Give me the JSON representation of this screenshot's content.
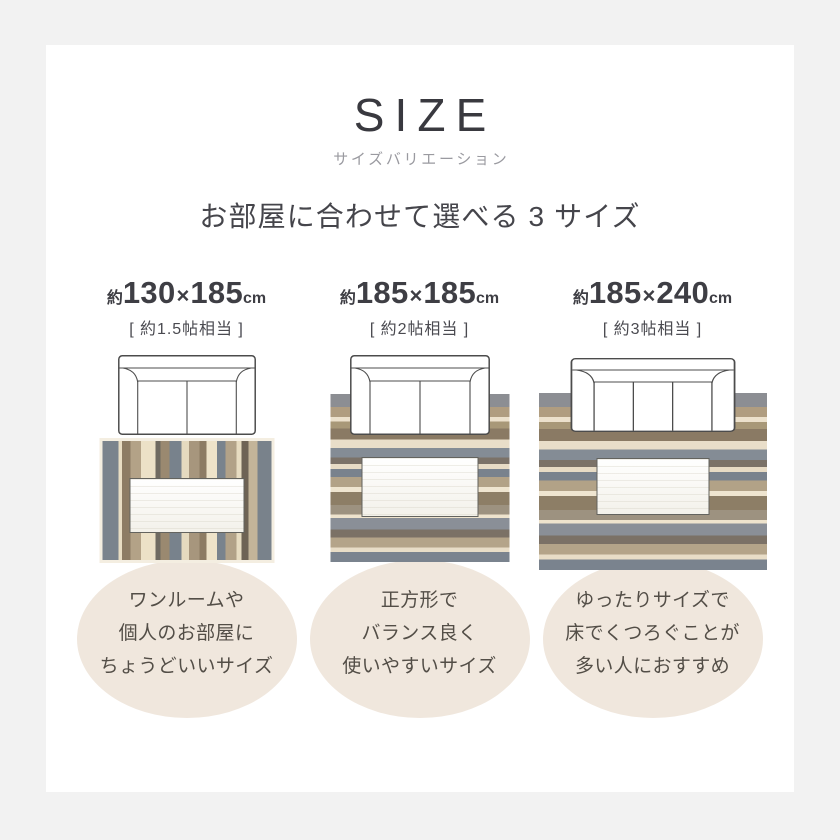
{
  "header": {
    "title": "SIZE",
    "subtitle": "サイズバリエーション",
    "heading": "お部屋に合わせて選べる 3 サイズ"
  },
  "sizes": [
    {
      "approx": "約",
      "width": "130",
      "separator": "×",
      "depth": "185",
      "unit": "cm",
      "equivalent": "[ 約1.5帖相当 ]",
      "description_lines": [
        "ワンルームや",
        "個人のお部屋に",
        "ちょうどいいサイズ"
      ],
      "sofa_seats": 2,
      "rug_orientation": "vertical"
    },
    {
      "approx": "約",
      "width": "185",
      "separator": "×",
      "depth": "185",
      "unit": "cm",
      "equivalent": "[ 約2帖相当 ]",
      "description_lines": [
        "正方形で",
        "バランス良く",
        "使いやすいサイズ"
      ],
      "sofa_seats": 2,
      "rug_orientation": "horizontal"
    },
    {
      "approx": "約",
      "width": "185",
      "separator": "×",
      "depth": "240",
      "unit": "cm",
      "equivalent": "[ 約3帖相当 ]",
      "description_lines": [
        "ゆったりサイズで",
        "床でくつろぐことが",
        "多い人におすすめ"
      ],
      "sofa_seats": 3,
      "rug_orientation": "horizontal"
    }
  ],
  "colors": {
    "page_bg": "#f2f2f2",
    "card_bg": "#ffffff",
    "circle_bg": "#f0e7dd",
    "sofa_outline": "#4c4c4c",
    "sofa_fill": "#ffffff"
  },
  "rug_palettes": {
    "vertical": [
      {
        "c": "#7a838d",
        "w": 9
      },
      {
        "c": "#e8ddc3",
        "w": 2
      },
      {
        "c": "#8d7c64",
        "w": 5
      },
      {
        "c": "#b3a287",
        "w": 6
      },
      {
        "c": "#ece1c7",
        "w": 8
      },
      {
        "c": "#6f6a61",
        "w": 3
      },
      {
        "c": "#9a8970",
        "w": 5
      },
      {
        "c": "#78828c",
        "w": 7
      },
      {
        "c": "#e5dabf",
        "w": 4
      },
      {
        "c": "#a7967d",
        "w": 6
      },
      {
        "c": "#8d7c64",
        "w": 4
      },
      {
        "c": "#eee3c9",
        "w": 6
      },
      {
        "c": "#79838d",
        "w": 5
      },
      {
        "c": "#b2a288",
        "w": 6
      },
      {
        "c": "#e7dcc1",
        "w": 3
      },
      {
        "c": "#6e6355",
        "w": 4
      },
      {
        "c": "#c3b499",
        "w": 5
      },
      {
        "c": "#79828b",
        "w": 8
      }
    ],
    "horizontal": [
      {
        "c": "#8c8e93",
        "w": 8
      },
      {
        "c": "#b09d80",
        "w": 6
      },
      {
        "c": "#ece1cc",
        "w": 3
      },
      {
        "c": "#a89878",
        "w": 4
      },
      {
        "c": "#8a7a64",
        "w": 7
      },
      {
        "c": "#e9dec9",
        "w": 5
      },
      {
        "c": "#848c95",
        "w": 6
      },
      {
        "c": "#7b7268",
        "w": 4
      },
      {
        "c": "#e7dbc5",
        "w": 3
      },
      {
        "c": "#79828d",
        "w": 5
      },
      {
        "c": "#b2a287",
        "w": 6
      },
      {
        "c": "#efe5d0",
        "w": 3
      },
      {
        "c": "#8d7e66",
        "w": 8
      },
      {
        "c": "#9d9280",
        "w": 6
      },
      {
        "c": "#eee3cd",
        "w": 2
      },
      {
        "c": "#8a8f97",
        "w": 7
      },
      {
        "c": "#7b7166",
        "w": 5
      },
      {
        "c": "#b4a489",
        "w": 6
      },
      {
        "c": "#e8ddc7",
        "w": 3
      },
      {
        "c": "#7a838e",
        "w": 6
      }
    ]
  }
}
